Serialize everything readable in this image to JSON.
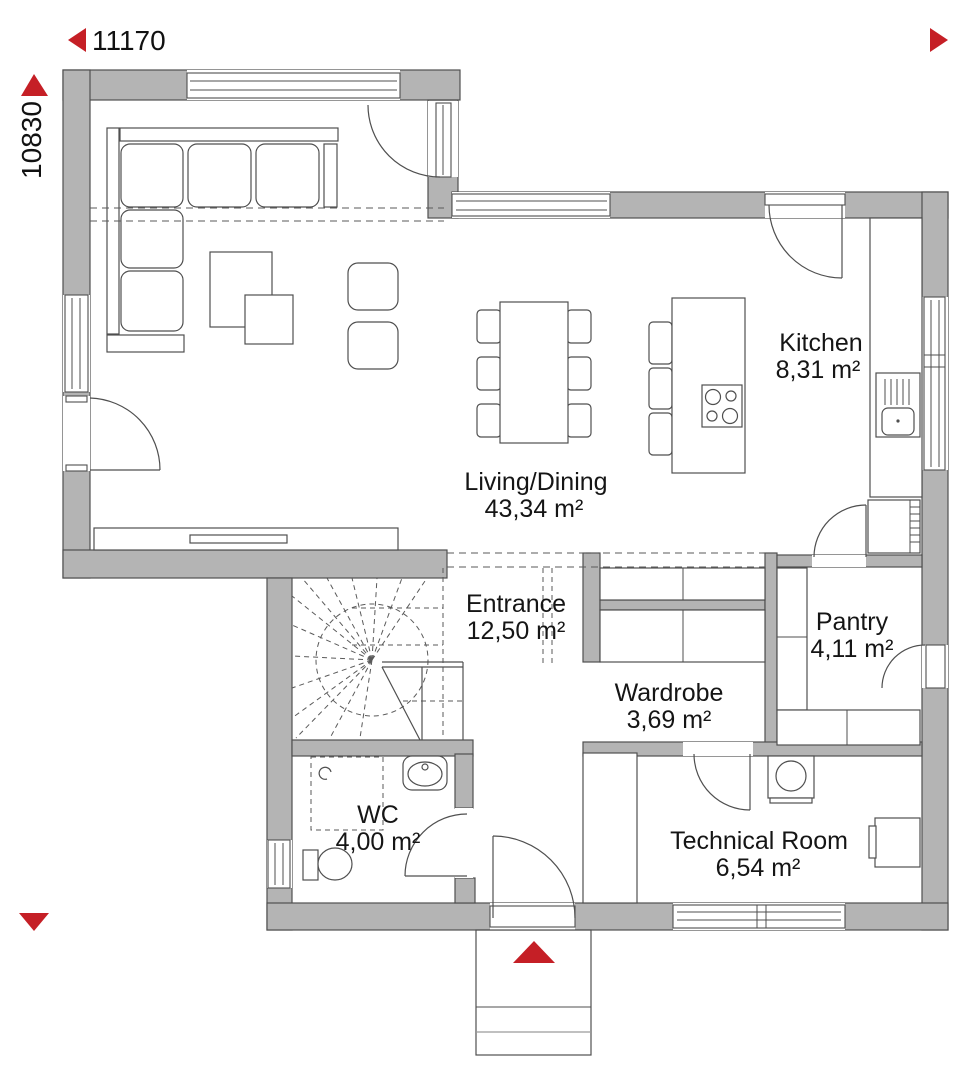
{
  "dimensions": {
    "width_label": "11170",
    "height_label": "10830"
  },
  "rooms": {
    "living": {
      "name": "Living/Dining",
      "area": "43,34 m²"
    },
    "kitchen": {
      "name": "Kitchen",
      "area": "8,31 m²"
    },
    "entrance": {
      "name": "Entrance",
      "area": "12,50 m²"
    },
    "wardrobe": {
      "name": "Wardrobe",
      "area": "3,69 m²"
    },
    "pantry": {
      "name": "Pantry",
      "area": "4,11 m²"
    },
    "wc": {
      "name": "WC",
      "area": "4,00 m²"
    },
    "technical": {
      "name": "Technical Room",
      "area": "6,54 m²"
    }
  },
  "colors": {
    "wall_fill": "#b4b4b4",
    "line": "#4f4f4f",
    "accent_red": "#c51f26",
    "text": "#151515"
  },
  "icons": {
    "dimension_arrows": [
      "arrow-left",
      "arrow-right",
      "arrow-up",
      "arrow-down"
    ],
    "entrance_marker": "arrow-up"
  }
}
